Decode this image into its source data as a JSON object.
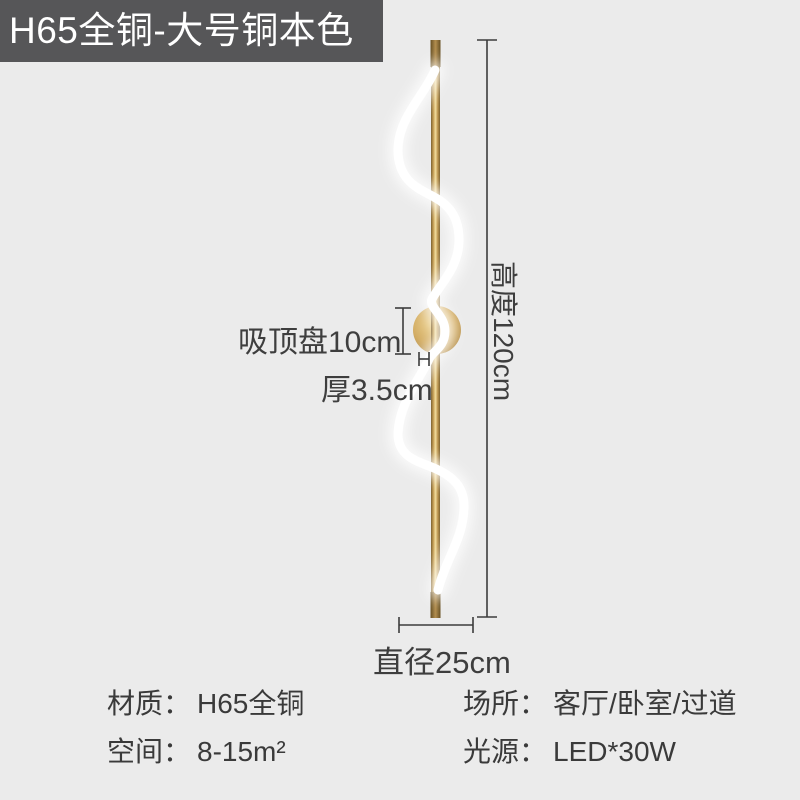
{
  "banner": {
    "title": "H65全铜-大号铜本色"
  },
  "dimensions": {
    "height_label": "高度120cm",
    "plate_label": "吸顶盘10cm",
    "thickness_label": "厚3.5cm",
    "diameter_label": "直径25cm"
  },
  "specs": {
    "left": [
      {
        "label": "材质：",
        "value": "H65全铜"
      },
      {
        "label": "空间：",
        "value": "8-15m²"
      }
    ],
    "right": [
      {
        "label": "场所：",
        "value": "客厅/卧室/过道"
      },
      {
        "label": "光源：",
        "value": "LED*30W"
      }
    ]
  },
  "colors": {
    "background": "#ebebeb",
    "banner_bg": "#565658",
    "banner_text": "#ffffff",
    "annotation_text": "#3e3e3e",
    "dimension_line": "#3c3c3c",
    "brass_gold": "#d4af64",
    "brass_dark": "#7c612f",
    "led_white": "#ffffff"
  }
}
